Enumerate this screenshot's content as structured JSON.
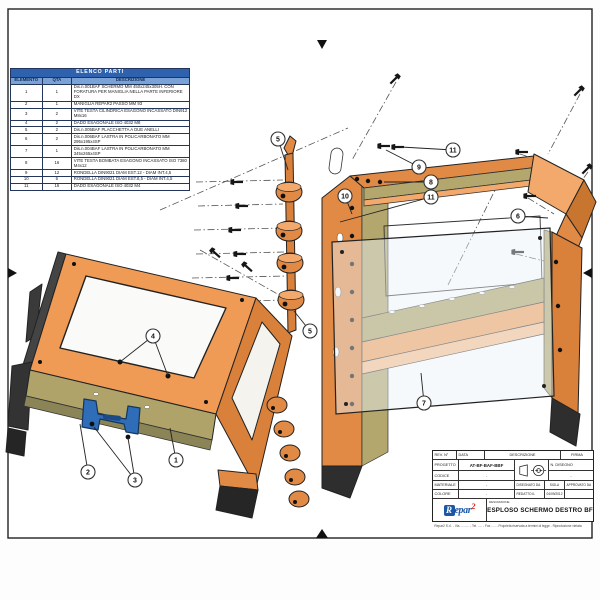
{
  "sheet": {
    "parts_table": {
      "title": "ELENCO PARTI",
      "columns": [
        "ELEMENTO",
        "QTA",
        "DESCRIZIONE"
      ],
      "rows": [
        [
          "1",
          "1",
          "Dis.n.001BAF SCHERMO MM 450x245x305H. CON FORATURA PER MANIGLIA NELLA PARTE INFERIORE DX"
        ],
        [
          "2",
          "1",
          "MANIGLIA REPAR2 PASSO MM 93"
        ],
        [
          "3",
          "2",
          "VITE TESTA CILINDRICA ESAGONO INCASSATO DIN912 M8x16"
        ],
        [
          "4",
          "2",
          "DADO ESAGONALE ISO 4032 M8"
        ],
        [
          "5",
          "2",
          "Dis.n.005BAF PLACCHETTA A DUE ANELLI"
        ],
        [
          "6",
          "2",
          "Dis.n.006BAF LASTRA IN POLICARBONATO MM 295x195x4SP"
        ],
        [
          "7",
          "1",
          "Dis.n.004BAF LASTRA IN POLICARBONATO MM 345x265x4SP"
        ],
        [
          "8",
          "16",
          "VITE TESTA BOMBATA ESAGONO INCASSATO ISO 7380 M4x12"
        ],
        [
          "9",
          "12",
          "RONDELLA DIN9021 DIAM EST.12 - DIAM INT.4,5"
        ],
        [
          "10",
          "6",
          "RONDELLA DIN9021 DIAM EST.8,5 - DIAM INT.4,5"
        ],
        [
          "11",
          "16",
          "DADO ESAGONALE ISO 4032 M4"
        ]
      ]
    },
    "title_block": {
      "rev_label": "REV. N°",
      "date_label": "DATA",
      "desc_label": "DESCRIZIONE",
      "firma_label": "FIRMA",
      "progetto_label": "PROGETTO",
      "progetto_value": "AT-BF-BAF-BBF",
      "codice_label": "CODICE",
      "codice_value": "-",
      "materiale_label": "MATERIALE",
      "materiale_value": "-",
      "colore_label": "COLORE",
      "colore_value": "-",
      "n_disegno_label": "N. DISEGNO",
      "n_disegno_value": "-",
      "disegnato_label": "DISEGNATO DA",
      "sigla_label": "SIGLA",
      "approvato_label": "APPROVATO DA",
      "redatto_label": "REDATTO IL",
      "redatto_value": "04/09/2012",
      "descrizione_label": "DESCRIZIONE",
      "drawing_title": "ESPLOSO SCHERMO DESTRO BF"
    },
    "logo": {
      "r": "R",
      "epar": "epar",
      "two": "2"
    },
    "footer_note": "Repar2 S.r.l. - Via .......... - Tel. ..... - Fax ..... - Proprietà riservata a termini di legge - Riproduzione vietata"
  },
  "balloons": [
    {
      "label": "4",
      "x": 153,
      "y": 336,
      "targets": [
        [
          120,
          362
        ],
        [
          168,
          376
        ]
      ]
    },
    {
      "label": "1",
      "x": 176,
      "y": 460,
      "targets": [
        [
          170,
          428
        ]
      ]
    },
    {
      "label": "2",
      "x": 88,
      "y": 472,
      "targets": [
        [
          80,
          424
        ]
      ]
    },
    {
      "label": "3",
      "x": 135,
      "y": 480,
      "targets": [
        [
          94,
          427
        ],
        [
          128,
          438
        ]
      ]
    },
    {
      "label": "5",
      "x": 278,
      "y": 139,
      "targets": [
        [
          288,
          170
        ]
      ]
    },
    {
      "label": "5",
      "x": 310,
      "y": 331,
      "targets": [
        [
          294,
          311
        ]
      ]
    },
    {
      "label": "9",
      "x": 419,
      "y": 167,
      "targets": [
        [
          386,
          150
        ]
      ]
    },
    {
      "label": "11",
      "x": 453,
      "y": 150,
      "targets": [
        [
          401,
          147
        ]
      ]
    },
    {
      "label": "8",
      "x": 431,
      "y": 182,
      "targets": [
        [
          384,
          182
        ]
      ]
    },
    {
      "label": "11",
      "x": 431,
      "y": 197,
      "targets": [
        [
          340,
          222
        ]
      ]
    },
    {
      "label": "10",
      "x": 345,
      "y": 196,
      "targets": [
        [
          352,
          214
        ]
      ]
    },
    {
      "label": "6",
      "x": 518,
      "y": 216,
      "targets": [
        [
          548,
          218
        ]
      ]
    },
    {
      "label": "7",
      "x": 424,
      "y": 403,
      "targets": [
        [
          421,
          373
        ]
      ]
    }
  ],
  "colors": {
    "frame_orange": "#e08a45",
    "frame_orange_light": "#f2a96b",
    "frame_orange_dark": "#c8762f",
    "panel_olive": "#b3a76d",
    "handle_blue": "#2f6db8",
    "table_header_blue": "#2f62ae",
    "table_subheader_blue": "#7aa2d6",
    "logo_blue": "#1a57a5",
    "logo_red": "#d42a20"
  }
}
